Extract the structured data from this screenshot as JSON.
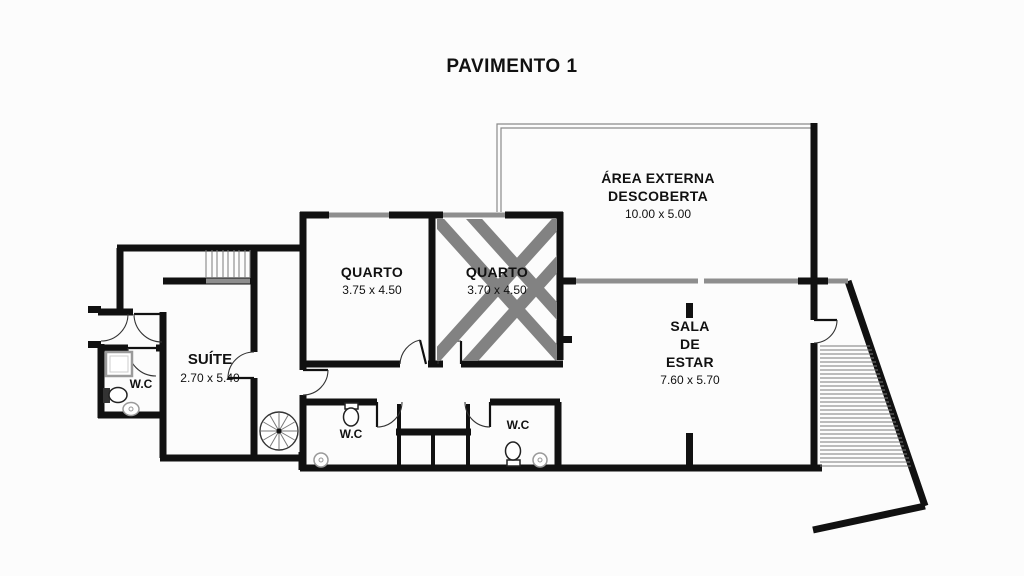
{
  "title": "PAVIMENTO 1",
  "colors": {
    "wall": "#111111",
    "window_glass": "#8e8e8e",
    "x_mark": "#828282",
    "stair_tread": "#7a7a7a",
    "background": "#fcfcfc"
  },
  "rooms": {
    "area_externa": {
      "line1": "ÁREA EXTERNA",
      "line2": "DESCOBERTA",
      "dims": "10.00 x 5.00"
    },
    "quarto1": {
      "label": "QUARTO",
      "dims": "3.75 x 4.50"
    },
    "quarto2": {
      "label": "QUARTO",
      "dims": "3.70 x 4.50"
    },
    "sala": {
      "line1": "SALA",
      "line2": "DE",
      "line3": "ESTAR",
      "dims": "7.60 x 5.70"
    },
    "suite": {
      "label": "SUÍTE",
      "dims": "2.70 x 5.40"
    },
    "wc_suite": {
      "label": "W.C"
    },
    "wc_left": {
      "label": "W.C"
    },
    "wc_right": {
      "label": "W.C"
    }
  },
  "icons": [
    "staircase-icon",
    "spiral-staircase-icon",
    "external-staircase-icon",
    "toilet-icon",
    "sink-icon",
    "shower-icon",
    "door-swing-icon",
    "x-mark-icon",
    "window-glass"
  ]
}
